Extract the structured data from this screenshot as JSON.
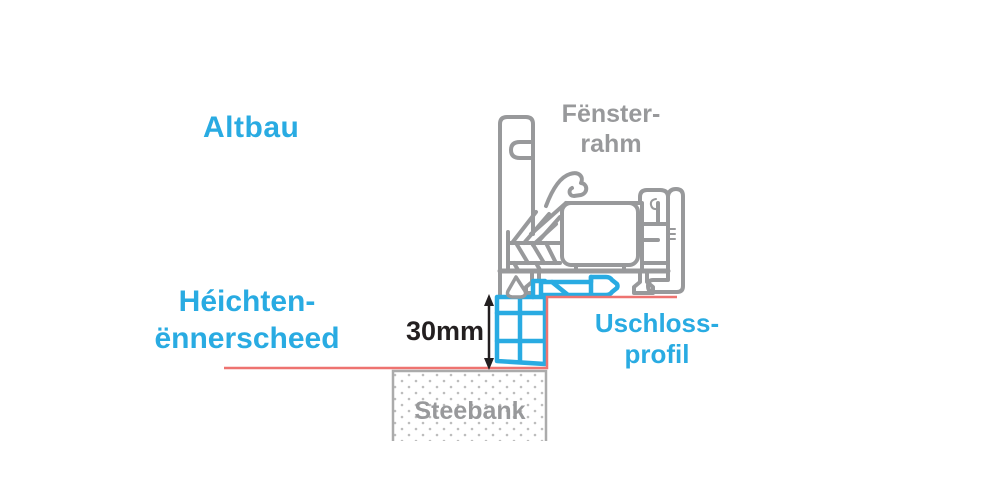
{
  "colors": {
    "accent-blue": "#29abe2",
    "drawing-gray": "#98999b",
    "level-line-red": "#ee7370",
    "text-black": "#231f20",
    "sill-border-gray": "#ababab",
    "sill-dot-gray": "#bdbdbd"
  },
  "labels": {
    "building": "Altbau",
    "window_frame_line1": "Fënster-",
    "window_frame_line2": "rahm",
    "height_difference_line1": "Héichten-",
    "height_difference_line2": "ënnerscheed",
    "dimension": "30mm",
    "connection_profile_line1": "Uschloss-",
    "connection_profile_line2": "profil",
    "window_sill": "Steebank"
  }
}
